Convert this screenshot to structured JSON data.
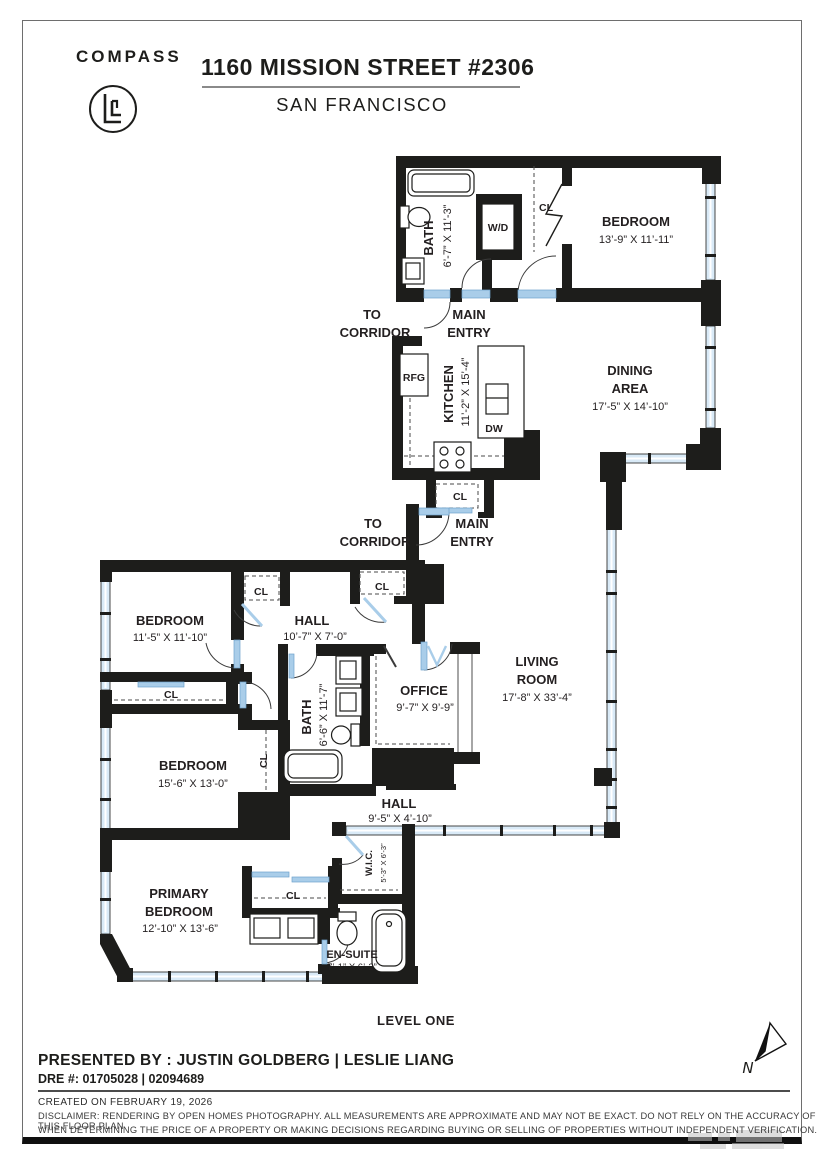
{
  "header": {
    "brand": "COMPASS",
    "title": "1160 MISSION STREET #2306",
    "subtitle": "SAN FRANCISCO"
  },
  "plan": {
    "level_label": "LEVEL ONE",
    "compass_n": "N",
    "labels": {
      "cl": "CL",
      "wd": "W/D",
      "rfg": "RFG",
      "dw": "DW",
      "to_line1": "TO",
      "to_line2": "CORRIDOR",
      "main_line1": "MAIN",
      "main_line2": "ENTRY"
    },
    "rooms": {
      "bath1": {
        "name": "BATH",
        "dims": "6’-7” X 11’-3”"
      },
      "bedroom1": {
        "name": "BEDROOM",
        "dims": "13’-9” X 11’-11”"
      },
      "kitchen": {
        "name": "KITCHEN",
        "dims": "11’-2” X 15’-4”"
      },
      "dining": {
        "name1": "DINING",
        "name2": "AREA",
        "dims": "17’-5” X 14’-10”"
      },
      "bedroom2": {
        "name": "BEDROOM",
        "dims": "11’-5” X 11’-10”"
      },
      "hall1": {
        "name": "HALL",
        "dims": "10’-7” X 7’-0”"
      },
      "living": {
        "name1": "LIVING",
        "name2": "ROOM",
        "dims": "17’-8” X 33’-4”"
      },
      "office": {
        "name": "OFFICE",
        "dims": "9’-7” X 9’-9”"
      },
      "bath2": {
        "name": "BATH",
        "dims": "6’-6” X 11’-7”"
      },
      "bedroom3": {
        "name": "BEDROOM",
        "dims": "15’-6” X 13’-0”"
      },
      "hall2": {
        "name": "HALL",
        "dims": "9’-5” X 4’-10”"
      },
      "wic": {
        "name": "W.I.C.",
        "dims": "5’-3” X 6’-3”"
      },
      "primary": {
        "name1": "PRIMARY",
        "name2": "BEDROOM",
        "dims": "12’-10” X 13’-6”"
      },
      "ensuite": {
        "name": "EN-SUITE",
        "dims": "7’-1” X 6’-2”"
      }
    }
  },
  "footer": {
    "presented_by": "PRESENTED BY : JUSTIN GOLDBERG | LESLIE LIANG",
    "dre": "DRE #: 01705028 | 02094689",
    "created": "CREATED ON FEBRUARY 19, 2026",
    "disclaimer_line1": "DISCLAIMER: RENDERING BY OPEN HOMES PHOTOGRAPHY. ALL MEASUREMENTS ARE APPROXIMATE AND MAY NOT BE EXACT. DO NOT RELY ON THE ACCURACY OF THIS FLOOR PLAN",
    "disclaimer_line2": "WHEN DETERMINING THE PRICE OF A PROPERTY OR MAKING DECISIONS REGARDING BUYING OR SELLING OF PROPERTIES WITHOUT INDEPENDENT VERIFICATION."
  },
  "colors": {
    "wall": "#1d1d1b",
    "window_fill": "#d9eaf7",
    "door_blue": "#a9cde9",
    "text": "#231f20"
  }
}
